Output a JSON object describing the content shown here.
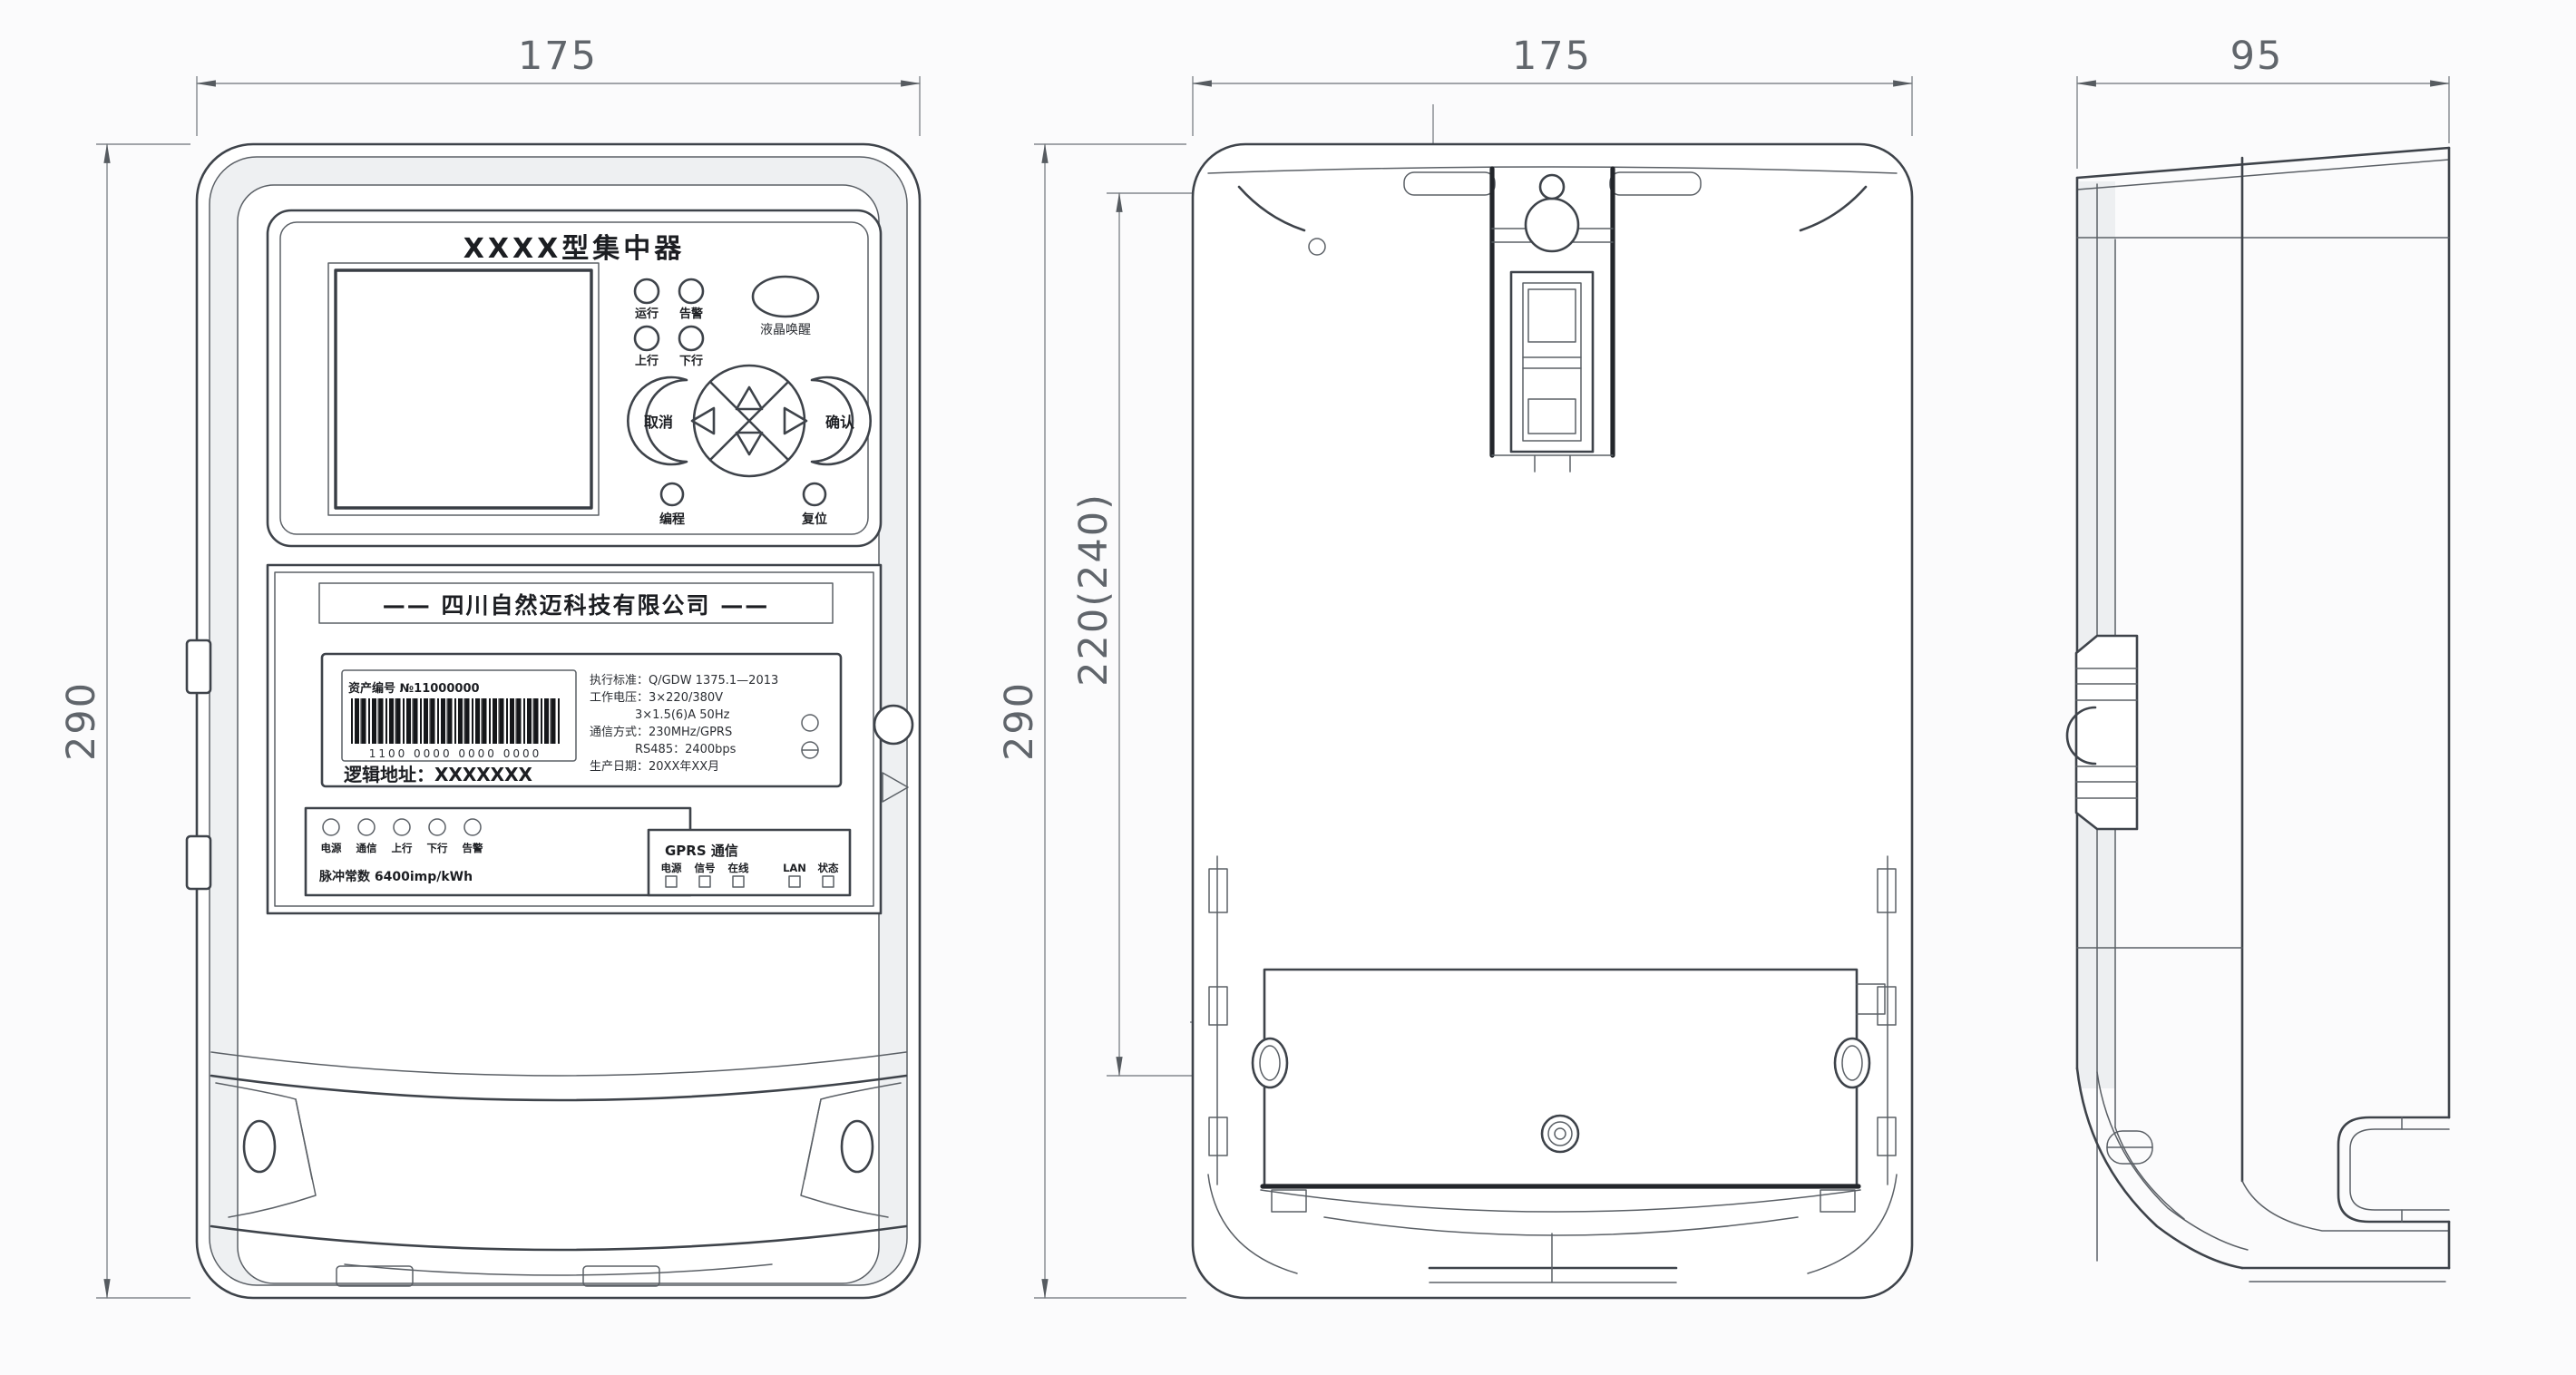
{
  "dimensions": {
    "front_width": "175",
    "back_width": "175",
    "side_width": "95",
    "front_height": "290",
    "back_height": "290",
    "back_inner_height": "220(240)",
    "hanger_hole_offset": "10",
    "mounting_hole_span": "150",
    "mounting_offset_horizontal": "5",
    "mounting_offset_vertical": "9",
    "marker_left": "O",
    "marker_right": "D"
  },
  "front_panel": {
    "model_title": "XXXX型集中器",
    "status_leds": [
      "运行",
      "告警",
      "上行",
      "下行"
    ],
    "wake_button_label": "液晶唤醒",
    "cancel_button_label": "取消",
    "confirm_button_label": "确认",
    "program_button_label": "编程",
    "reset_button_label": "复位",
    "company_name": "—— 四川自然迈科技有限公司 ——",
    "nameplate": {
      "barcode_caption": "资产编号 №11000000",
      "barcode_number": "1100 0000 0000 0000",
      "logic_address": "逻辑地址：XXXXXXX",
      "spec_lines": [
        "执行标准：Q/GDW 1375.1—2013",
        "工作电压：3×220/380V",
        "3×1.5(6)A 50Hz",
        "通信方式：230MHz/GPRS",
        "RS485：2400bps",
        "生产日期：20XX年XX月"
      ]
    },
    "indicator_panel": {
      "leds": [
        "电源",
        "通信",
        "上行",
        "下行",
        "告警"
      ],
      "note": "脉冲常数 6400imp/kWh"
    },
    "comm_panel": {
      "title": "GPRS 通信",
      "labels": [
        "电源",
        "信号",
        "在线",
        "LAN",
        "状态"
      ]
    }
  }
}
